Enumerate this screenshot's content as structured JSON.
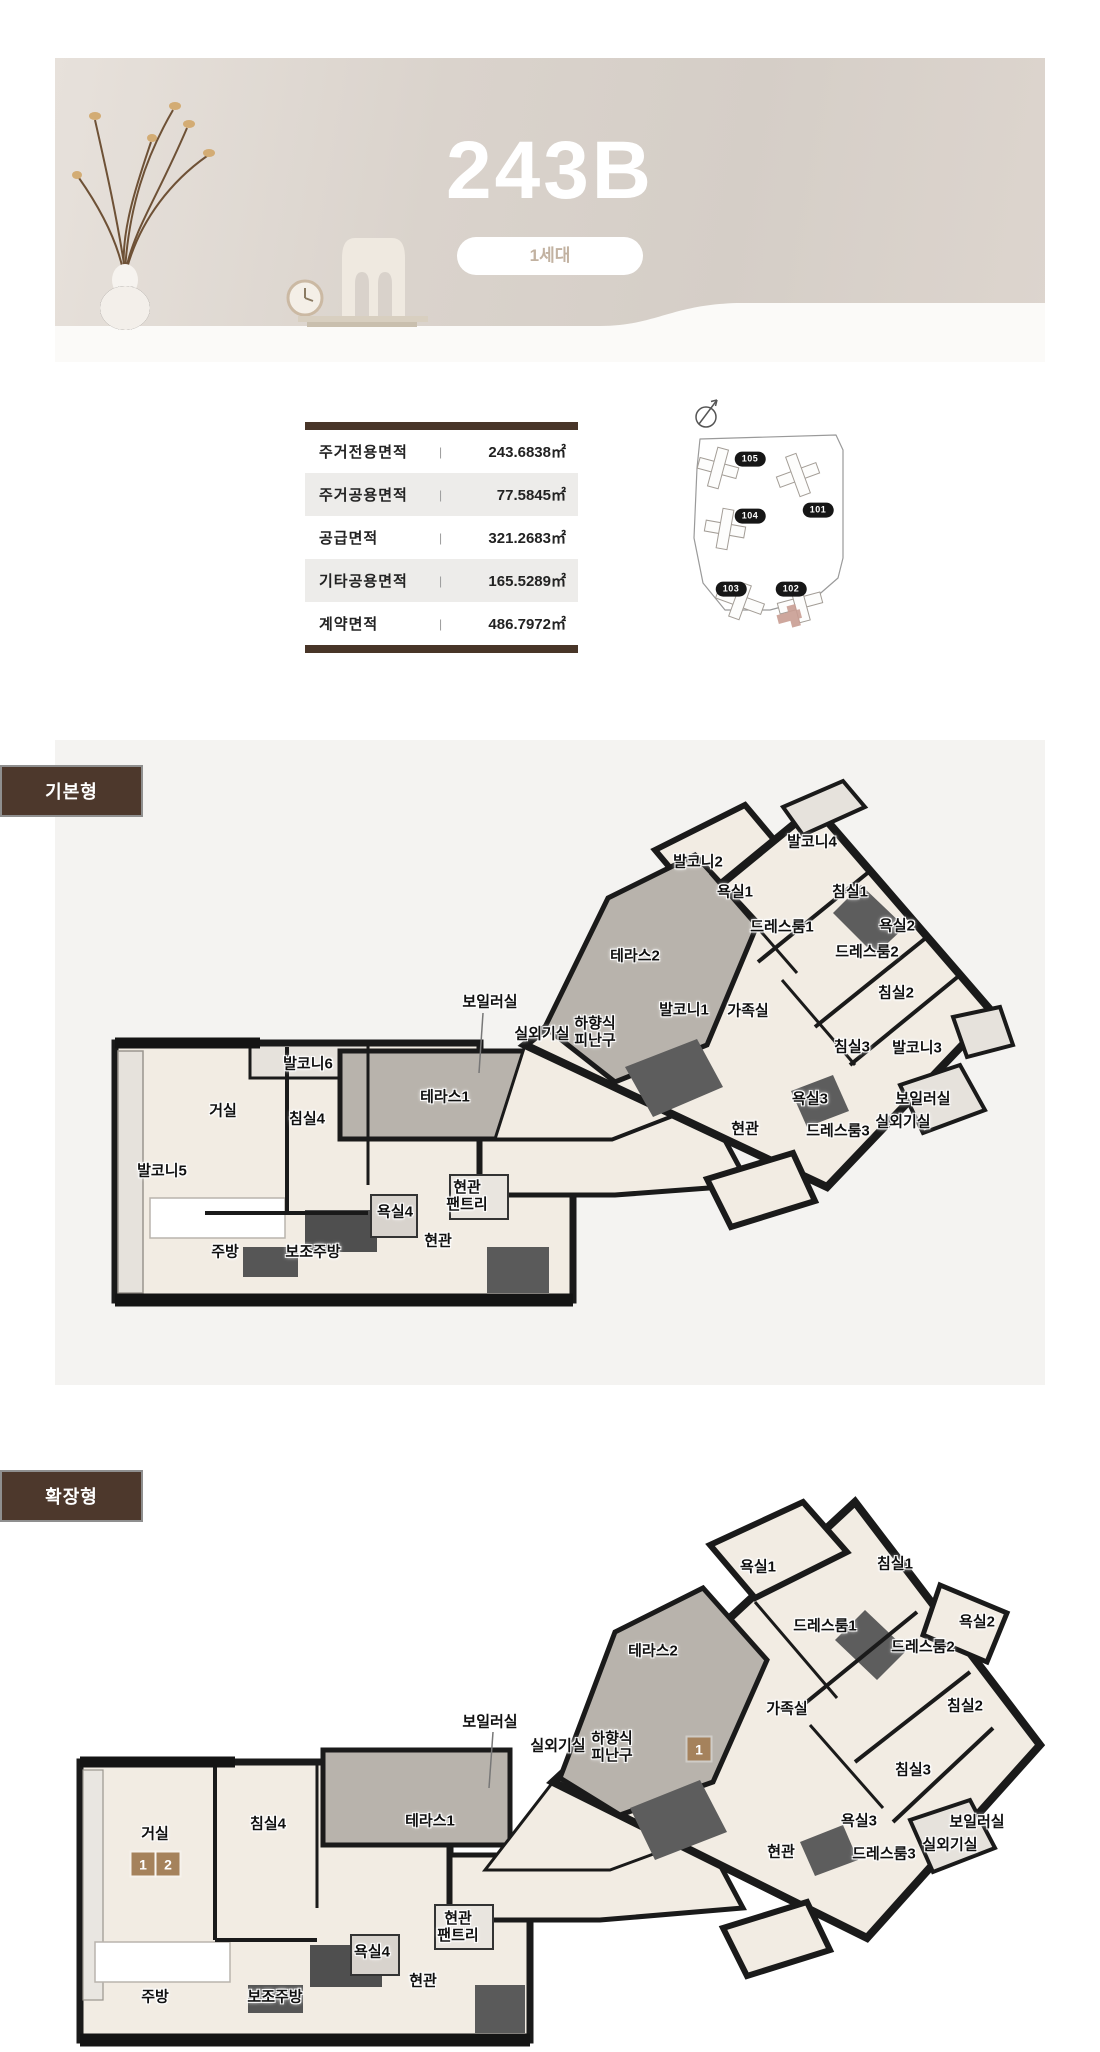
{
  "hero": {
    "title": "243B",
    "badge": "1세대"
  },
  "colors": {
    "accent_brown": "#483528",
    "tab_brown": "#4d382c",
    "badge_text": "#c2b2a1",
    "room_fill": "#f2ece3",
    "terrace_gray": "#b8b3ac",
    "highlight_pink": "#c99e93",
    "option_badge_brown": "#a5825c"
  },
  "area_table": {
    "separator": "|",
    "rows": [
      {
        "label": "주거전용면적",
        "value": "243.6838㎡"
      },
      {
        "label": "주거공용면적",
        "value": "77.5845㎡"
      },
      {
        "label": "공급면적",
        "value": "321.2683㎡"
      },
      {
        "label": "기타공용면적",
        "value": "165.5289㎡"
      },
      {
        "label": "계약면적",
        "value": "486.7972㎡"
      }
    ]
  },
  "site_plan": {
    "buildings": [
      {
        "label": "105",
        "px": 95,
        "py": 66,
        "highlighted": false
      },
      {
        "label": "101",
        "px": 163,
        "py": 117,
        "highlighted": false
      },
      {
        "label": "104",
        "px": 95,
        "py": 123,
        "highlighted": false
      },
      {
        "label": "103",
        "px": 76,
        "py": 196,
        "highlighted": false
      },
      {
        "label": "102",
        "px": 136,
        "py": 196,
        "highlighted": true
      }
    ]
  },
  "plans": [
    {
      "tab": "기본형",
      "labels": [
        {
          "text": "발코니4",
          "x": 757,
          "y": 88
        },
        {
          "text": "발코니2",
          "x": 643,
          "y": 108
        },
        {
          "text": "욕실1",
          "x": 680,
          "y": 138
        },
        {
          "text": "침실1",
          "x": 795,
          "y": 138
        },
        {
          "text": "드레스룸1",
          "x": 727,
          "y": 173
        },
        {
          "text": "욕실2",
          "x": 842,
          "y": 172
        },
        {
          "text": "드레스룸2",
          "x": 812,
          "y": 198
        },
        {
          "text": "테라스2",
          "x": 580,
          "y": 202
        },
        {
          "text": "침실2",
          "x": 841,
          "y": 239
        },
        {
          "text": "보일러실",
          "x": 435,
          "y": 248
        },
        {
          "text": "실외기실",
          "x": 487,
          "y": 280
        },
        {
          "text": "하향식\n피난구",
          "x": 540,
          "y": 278
        },
        {
          "text": "발코니1",
          "x": 629,
          "y": 256
        },
        {
          "text": "가족실",
          "x": 693,
          "y": 257
        },
        {
          "text": "침실3",
          "x": 797,
          "y": 293
        },
        {
          "text": "발코니3",
          "x": 862,
          "y": 294
        },
        {
          "text": "발코니6",
          "x": 253,
          "y": 310
        },
        {
          "text": "테라스1",
          "x": 390,
          "y": 343
        },
        {
          "text": "거실",
          "x": 168,
          "y": 357
        },
        {
          "text": "침실4",
          "x": 252,
          "y": 365
        },
        {
          "text": "욕실3",
          "x": 755,
          "y": 345
        },
        {
          "text": "보일러실",
          "x": 868,
          "y": 345
        },
        {
          "text": "드레스룸3",
          "x": 783,
          "y": 377
        },
        {
          "text": "실외기실",
          "x": 848,
          "y": 368
        },
        {
          "text": "현관",
          "x": 690,
          "y": 375
        },
        {
          "text": "발코니5",
          "x": 107,
          "y": 417
        },
        {
          "text": "현관\n팬트리",
          "x": 412,
          "y": 442
        },
        {
          "text": "욕실4",
          "x": 340,
          "y": 458
        },
        {
          "text": "현관",
          "x": 383,
          "y": 487
        },
        {
          "text": "주방",
          "x": 170,
          "y": 498
        },
        {
          "text": "보조주방",
          "x": 258,
          "y": 498
        }
      ],
      "badges": []
    },
    {
      "tab": "확장형",
      "labels": [
        {
          "text": "욕실1",
          "x": 703,
          "y": 78
        },
        {
          "text": "침실1",
          "x": 840,
          "y": 75
        },
        {
          "text": "드레스룸1",
          "x": 770,
          "y": 137
        },
        {
          "text": "욕실2",
          "x": 922,
          "y": 133
        },
        {
          "text": "드레스룸2",
          "x": 868,
          "y": 158
        },
        {
          "text": "테라스2",
          "x": 598,
          "y": 162
        },
        {
          "text": "가족실",
          "x": 732,
          "y": 220
        },
        {
          "text": "침실2",
          "x": 910,
          "y": 217
        },
        {
          "text": "보일러실",
          "x": 435,
          "y": 233
        },
        {
          "text": "실외기실",
          "x": 503,
          "y": 257
        },
        {
          "text": "하향식\n피난구",
          "x": 557,
          "y": 258
        },
        {
          "text": "침실3",
          "x": 858,
          "y": 281
        },
        {
          "text": "테라스1",
          "x": 375,
          "y": 332
        },
        {
          "text": "침실4",
          "x": 213,
          "y": 335
        },
        {
          "text": "거실",
          "x": 100,
          "y": 345
        },
        {
          "text": "욕실3",
          "x": 804,
          "y": 332
        },
        {
          "text": "보일러실",
          "x": 922,
          "y": 333
        },
        {
          "text": "드레스룸3",
          "x": 829,
          "y": 365
        },
        {
          "text": "실외기실",
          "x": 895,
          "y": 356
        },
        {
          "text": "현관",
          "x": 726,
          "y": 363
        },
        {
          "text": "현관\n팬트리",
          "x": 403,
          "y": 438
        },
        {
          "text": "욕실4",
          "x": 317,
          "y": 463
        },
        {
          "text": "현관",
          "x": 368,
          "y": 492
        },
        {
          "text": "주방",
          "x": 100,
          "y": 508
        },
        {
          "text": "보조주방",
          "x": 220,
          "y": 508
        }
      ],
      "badges": [
        {
          "n": "1",
          "x": 644,
          "y": 259
        },
        {
          "n": "1",
          "x": 88,
          "y": 374
        },
        {
          "n": "2",
          "x": 113,
          "y": 374
        }
      ]
    }
  ]
}
